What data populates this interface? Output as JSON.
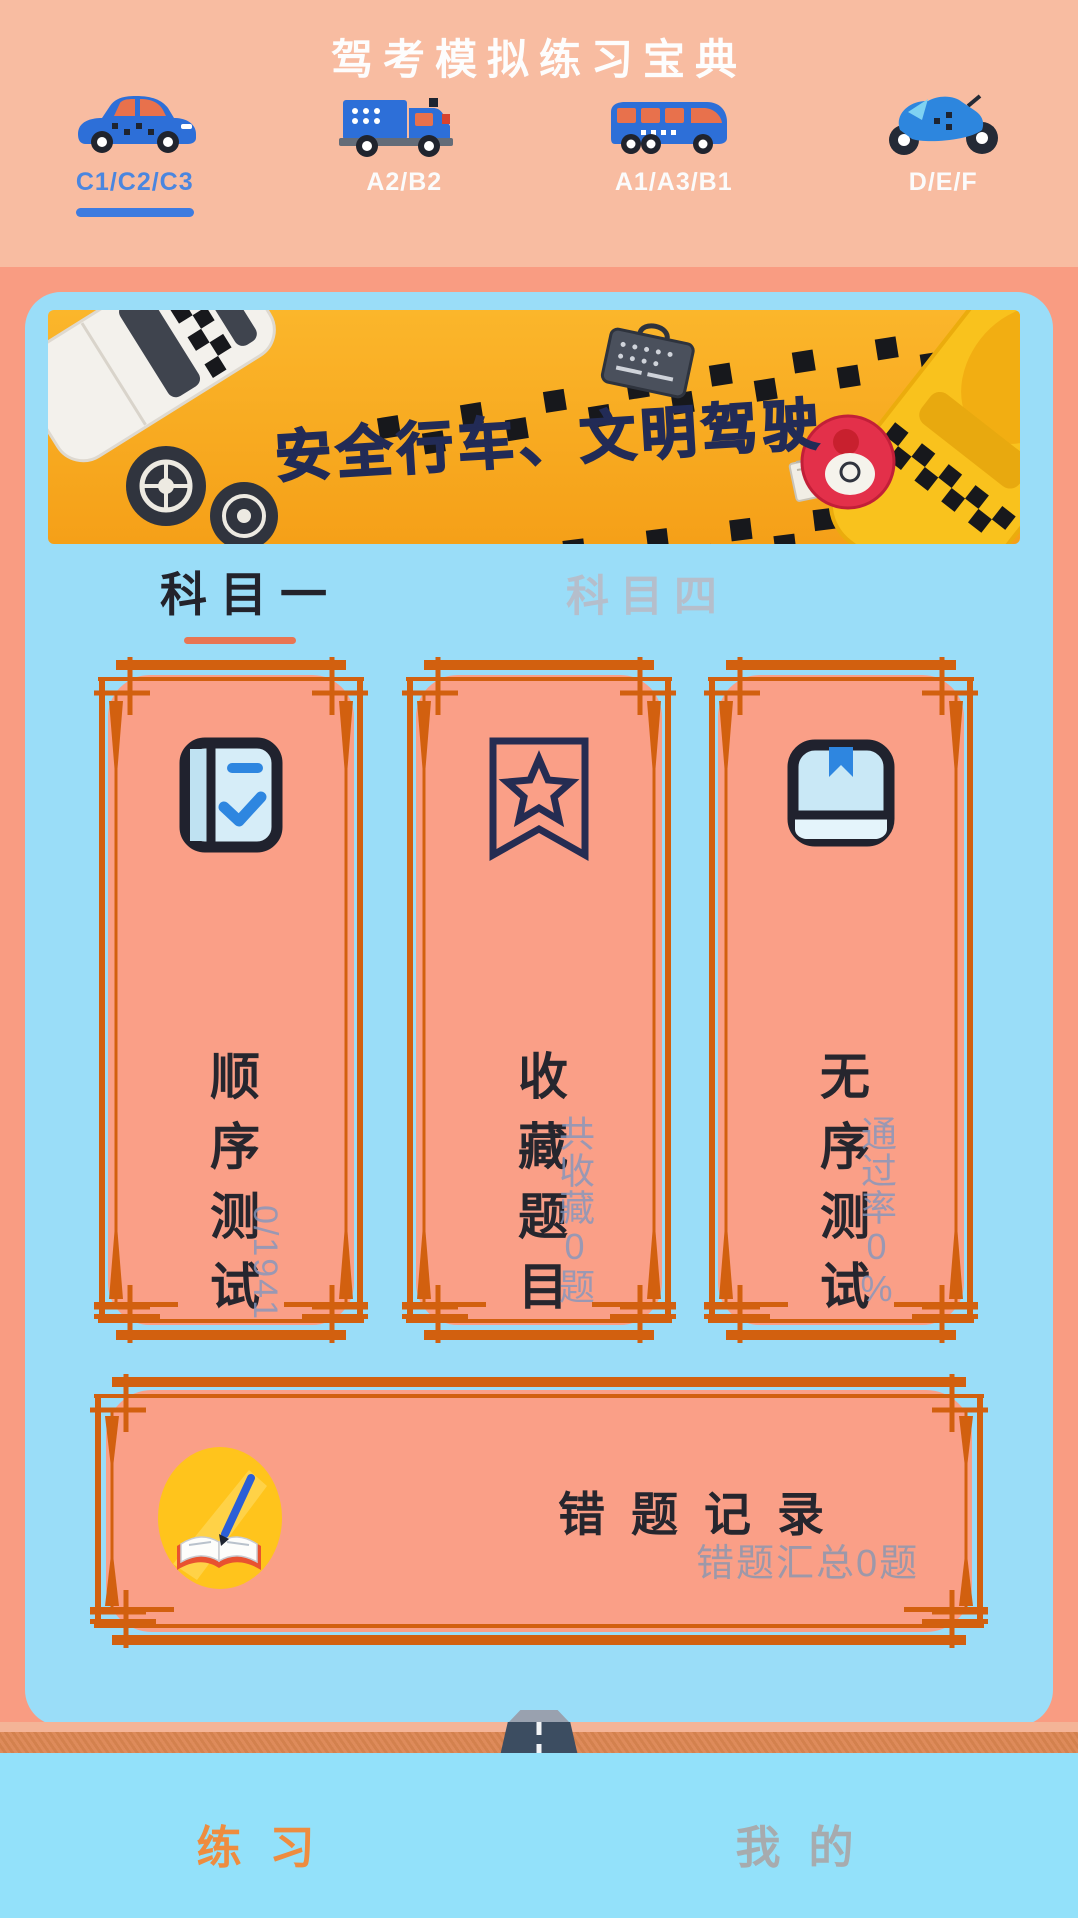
{
  "header": {
    "title": "驾考模拟练习宝典",
    "categories": [
      {
        "label": "C1/C2/C3",
        "icon": "car-icon",
        "active": true
      },
      {
        "label": "A2/B2",
        "icon": "truck-icon",
        "active": false
      },
      {
        "label": "A1/A3/B1",
        "icon": "bus-icon",
        "active": false
      },
      {
        "label": "D/E/F",
        "icon": "motorcycle-icon",
        "active": false
      }
    ]
  },
  "banner": {
    "slogan": "安全行车、文明驾驶"
  },
  "subject_tabs": [
    {
      "label": "科目一",
      "active": true
    },
    {
      "label": "科目四",
      "active": false
    }
  ],
  "cards": [
    {
      "title": "顺序测试",
      "stat": "0/1941",
      "icon": "book-check-icon"
    },
    {
      "title": "收藏题目",
      "stat": "共收藏0题",
      "icon": "bookmark-star-icon"
    },
    {
      "title": "无序测试",
      "stat": "通过率0%",
      "icon": "book-ribbon-icon"
    }
  ],
  "wrong_card": {
    "title": "错题记录",
    "stat": "错题汇总0题",
    "icon": "notebook-pencil-icon"
  },
  "bottom_nav": [
    {
      "label": "练习",
      "active": true
    },
    {
      "label": "我的",
      "active": false
    }
  ],
  "colors": {
    "header_bg": "#F8BCA1",
    "page_bg": "#F99C82",
    "panel_bg": "#9ADDF8",
    "card_bg": "#FA9F87",
    "frame_orange": "#D2600F",
    "active_tab_blue": "#3D7BE0",
    "subject_underline": "#E87553",
    "banner_orange": "#F7A81F",
    "nav_active": "#EE8C3F",
    "nav_inactive": "#A7ABAE",
    "stat_text": "#8296BE",
    "card_title_text": "#26262E"
  }
}
